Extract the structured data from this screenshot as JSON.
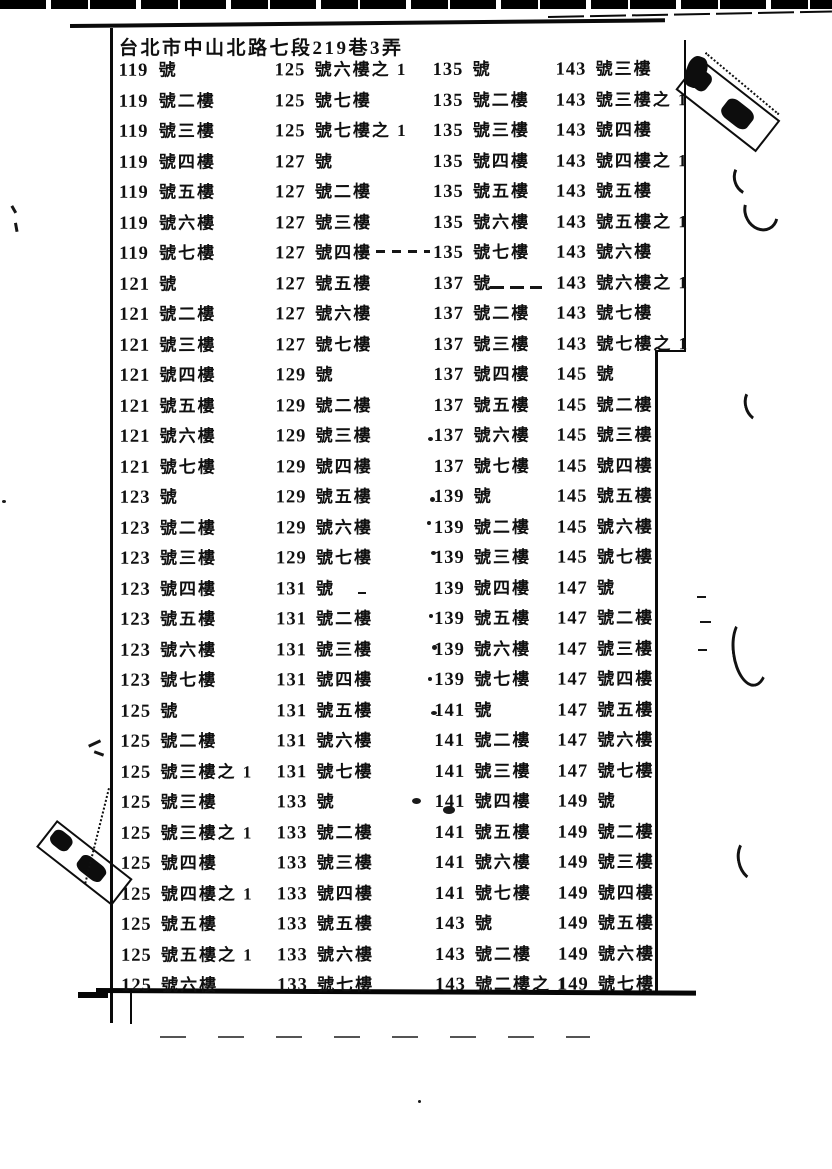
{
  "header": {
    "address": "台北市中山北路七段219巷3弄"
  },
  "table": {
    "columns": [
      [
        [
          "119",
          "號"
        ],
        [
          "119",
          "號二樓"
        ],
        [
          "119",
          "號三樓"
        ],
        [
          "119",
          "號四樓"
        ],
        [
          "119",
          "號五樓"
        ],
        [
          "119",
          "號六樓"
        ],
        [
          "119",
          "號七樓"
        ],
        [
          "121",
          "號"
        ],
        [
          "121",
          "號二樓"
        ],
        [
          "121",
          "號三樓"
        ],
        [
          "121",
          "號四樓"
        ],
        [
          "121",
          "號五樓"
        ],
        [
          "121",
          "號六樓"
        ],
        [
          "121",
          "號七樓"
        ],
        [
          "123",
          "號"
        ],
        [
          "123",
          "號二樓"
        ],
        [
          "123",
          "號三樓"
        ],
        [
          "123",
          "號四樓"
        ],
        [
          "123",
          "號五樓"
        ],
        [
          "123",
          "號六樓"
        ],
        [
          "123",
          "號七樓"
        ],
        [
          "125",
          "號"
        ],
        [
          "125",
          "號二樓"
        ],
        [
          "125",
          "號三樓之 1"
        ],
        [
          "125",
          "號三樓"
        ],
        [
          "125",
          "號三樓之 1"
        ],
        [
          "125",
          "號四樓"
        ],
        [
          "125",
          "號四樓之 1"
        ],
        [
          "125",
          "號五樓"
        ],
        [
          "125",
          "號五樓之 1"
        ],
        [
          "125",
          "號六樓"
        ]
      ],
      [
        [
          "125",
          "號六樓之 1"
        ],
        [
          "125",
          "號七樓"
        ],
        [
          "125",
          "號七樓之 1"
        ],
        [
          "127",
          "號"
        ],
        [
          "127",
          "號二樓"
        ],
        [
          "127",
          "號三樓"
        ],
        [
          "127",
          "號四樓"
        ],
        [
          "127",
          "號五樓"
        ],
        [
          "127",
          "號六樓"
        ],
        [
          "127",
          "號七樓"
        ],
        [
          "129",
          "號"
        ],
        [
          "129",
          "號二樓"
        ],
        [
          "129",
          "號三樓"
        ],
        [
          "129",
          "號四樓"
        ],
        [
          "129",
          "號五樓"
        ],
        [
          "129",
          "號六樓"
        ],
        [
          "129",
          "號七樓"
        ],
        [
          "131",
          "號"
        ],
        [
          "131",
          "號二樓"
        ],
        [
          "131",
          "號三樓"
        ],
        [
          "131",
          "號四樓"
        ],
        [
          "131",
          "號五樓"
        ],
        [
          "131",
          "號六樓"
        ],
        [
          "131",
          "號七樓"
        ],
        [
          "133",
          "號"
        ],
        [
          "133",
          "號二樓"
        ],
        [
          "133",
          "號三樓"
        ],
        [
          "133",
          "號四樓"
        ],
        [
          "133",
          "號五樓"
        ],
        [
          "133",
          "號六樓"
        ],
        [
          "133",
          "號七樓"
        ]
      ],
      [
        [
          "135",
          "號"
        ],
        [
          "135",
          "號二樓"
        ],
        [
          "135",
          "號三樓"
        ],
        [
          "135",
          "號四樓"
        ],
        [
          "135",
          "號五樓"
        ],
        [
          "135",
          "號六樓"
        ],
        [
          "135",
          "號七樓"
        ],
        [
          "137",
          "號"
        ],
        [
          "137",
          "號二樓"
        ],
        [
          "137",
          "號三樓"
        ],
        [
          "137",
          "號四樓"
        ],
        [
          "137",
          "號五樓"
        ],
        [
          "137",
          "號六樓"
        ],
        [
          "137",
          "號七樓"
        ],
        [
          "139",
          "號"
        ],
        [
          "139",
          "號二樓"
        ],
        [
          "139",
          "號三樓"
        ],
        [
          "139",
          "號四樓"
        ],
        [
          "139",
          "號五樓"
        ],
        [
          "139",
          "號六樓"
        ],
        [
          "139",
          "號七樓"
        ],
        [
          "141",
          "號"
        ],
        [
          "141",
          "號二樓"
        ],
        [
          "141",
          "號三樓"
        ],
        [
          "141",
          "號四樓"
        ],
        [
          "141",
          "號五樓"
        ],
        [
          "141",
          "號六樓"
        ],
        [
          "141",
          "號七樓"
        ],
        [
          "143",
          "號"
        ],
        [
          "143",
          "號二樓"
        ],
        [
          "143",
          "號二樓之 1"
        ]
      ],
      [
        [
          "143",
          "號三樓"
        ],
        [
          "143",
          "號三樓之 1"
        ],
        [
          "143",
          "號四樓"
        ],
        [
          "143",
          "號四樓之 1"
        ],
        [
          "143",
          "號五樓"
        ],
        [
          "143",
          "號五樓之 1"
        ],
        [
          "143",
          "號六樓"
        ],
        [
          "143",
          "號六樓之 1"
        ],
        [
          "143",
          "號七樓"
        ],
        [
          "143",
          "號七樓之 1"
        ],
        [
          "145",
          "號"
        ],
        [
          "145",
          "號二樓"
        ],
        [
          "145",
          "號三樓"
        ],
        [
          "145",
          "號四樓"
        ],
        [
          "145",
          "號五樓"
        ],
        [
          "145",
          "號六樓"
        ],
        [
          "145",
          "號七樓"
        ],
        [
          "147",
          "號"
        ],
        [
          "147",
          "號二樓"
        ],
        [
          "147",
          "號三樓"
        ],
        [
          "147",
          "號四樓"
        ],
        [
          "147",
          "號五樓"
        ],
        [
          "147",
          "號六樓"
        ],
        [
          "147",
          "號七樓"
        ],
        [
          "149",
          "號"
        ],
        [
          "149",
          "號二樓"
        ],
        [
          "149",
          "號三樓"
        ],
        [
          "149",
          "號四樓"
        ],
        [
          "149",
          "號五樓"
        ],
        [
          "149",
          "號六樓"
        ],
        [
          "149",
          "號七樓"
        ]
      ]
    ]
  },
  "colors": {
    "ink": "#101010",
    "paper": "#ffffff"
  }
}
